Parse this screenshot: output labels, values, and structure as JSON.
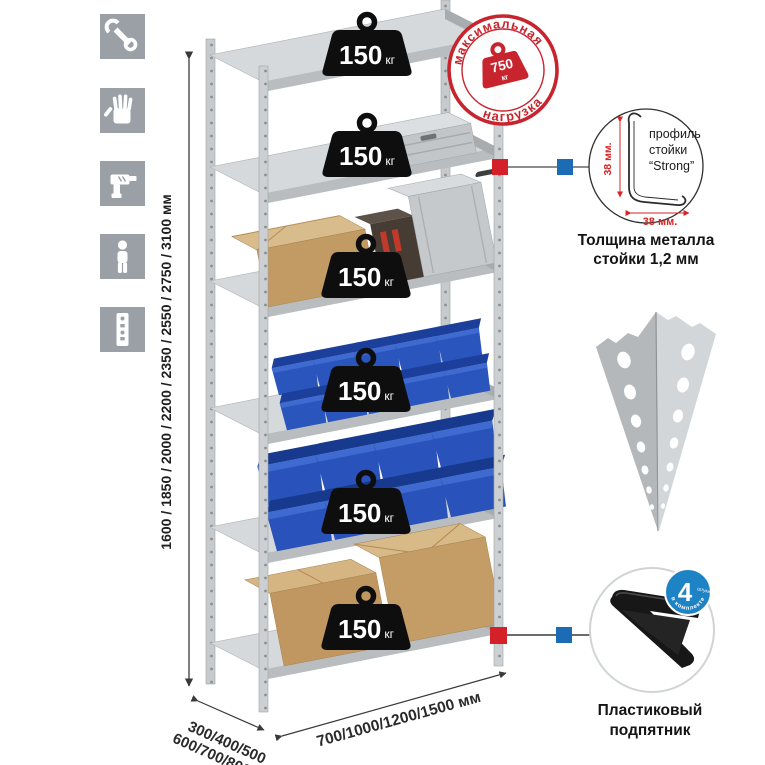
{
  "feature_icons": [
    {
      "name": "wrench"
    },
    {
      "name": "work-gloves"
    },
    {
      "name": "drill"
    },
    {
      "name": "person"
    },
    {
      "name": "perforated-post"
    }
  ],
  "stamp": {
    "arc_top": "максимальная",
    "arc_bottom": "нагрузка",
    "value": "750",
    "unit": "кг"
  },
  "shelves": {
    "unit": "кг",
    "weights": [
      "150",
      "150",
      "150",
      "150",
      "150",
      "150"
    ]
  },
  "dimensions": {
    "height": "1600 / 1850 / 2000 / 2200 / 2350 / 2550 / 2750 / 3100 мм",
    "depth_line1": "300/400/500",
    "depth_line2": "600/700/800 мм",
    "width": "700/1000/1200/1500 мм"
  },
  "profile_detail": {
    "line1": "профиль",
    "line2": "стойки",
    "line3": "“Strong”",
    "dim_v": "38 мм.",
    "dim_h": "38 мм.",
    "caption1": "Толщина металла",
    "caption2": "стойки 1,2 мм"
  },
  "foot_detail": {
    "badge_number": "4",
    "badge_small": "штуки",
    "badge_arc": "в комплекте",
    "caption1": "Пластиковый",
    "caption2": "подпятник"
  },
  "colors": {
    "stamp_red": "#c8242e",
    "marker_red": "#d42028",
    "marker_blue": "#1b6cb4",
    "badge_blue": "#1e83c4",
    "metal_light": "#d6d9db",
    "metal_mid": "#c7cacc",
    "metal_dark": "#a8acaf",
    "bin_blue": "#2a55bd",
    "cardboard": "#c29a63",
    "weight_black": "#0e0e0e",
    "icon_gray": "#9aa0a5"
  }
}
